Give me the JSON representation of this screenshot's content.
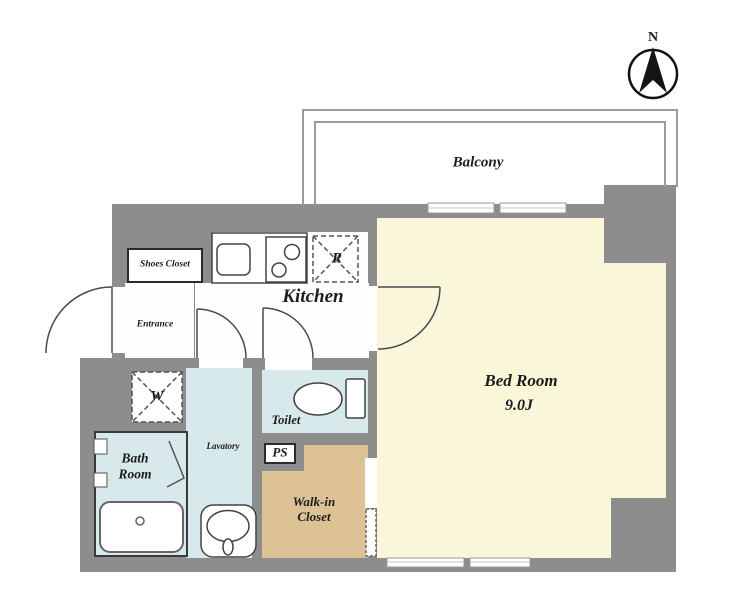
{
  "compass": {
    "north_label": "N"
  },
  "balcony": {
    "label": "Balcony"
  },
  "rooms": {
    "kitchen": "Kitchen",
    "shoes_closet": "Shoes Closet",
    "entrance": "Entrance",
    "refrigerator": "R",
    "washer": "W",
    "bath_room": "Bath Room",
    "lavatory": "Lavatory",
    "toilet": "Toilet",
    "pipe_space": "PS",
    "walk_in_closet": "Walk-in Closet",
    "bed_room_name": "Bed Room",
    "bed_room_size": "9.0J"
  },
  "colors": {
    "wall": "#8d8d8d",
    "bedroom_floor": "#f9f6da",
    "wet_area_floor": "#d7e9ea",
    "closet_floor": "#dcc295",
    "kitchen_floor": "#fefefe",
    "fixture_outline": "#444444",
    "balcony_outline": "#9b9b9b",
    "label_text": "#1c1c1c"
  }
}
